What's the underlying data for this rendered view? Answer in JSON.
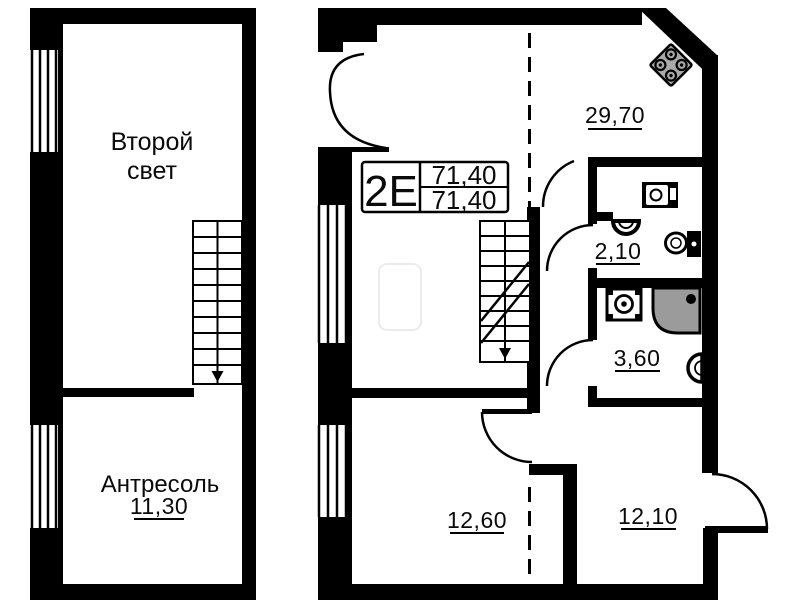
{
  "left_plan": {
    "upper_room": {
      "label_line1": "Второй",
      "label_line2": "свет"
    },
    "lower_room": {
      "label": "Антресоль",
      "area": "11,30"
    }
  },
  "right_plan": {
    "info_box": {
      "unit_type": "2Е",
      "area_total": "71,40",
      "area_living": "71,40"
    },
    "rooms": {
      "living": {
        "area": "29,70"
      },
      "wc": {
        "area": "2,10"
      },
      "bath": {
        "area": "3,60"
      },
      "room_left": {
        "area": "12,60"
      },
      "room_right": {
        "area": "12,10"
      }
    }
  },
  "colors": {
    "wall": "#000000",
    "shower_tray": "#9b9b9b",
    "stove_top": "#a9a9a9",
    "background": "#ffffff"
  }
}
